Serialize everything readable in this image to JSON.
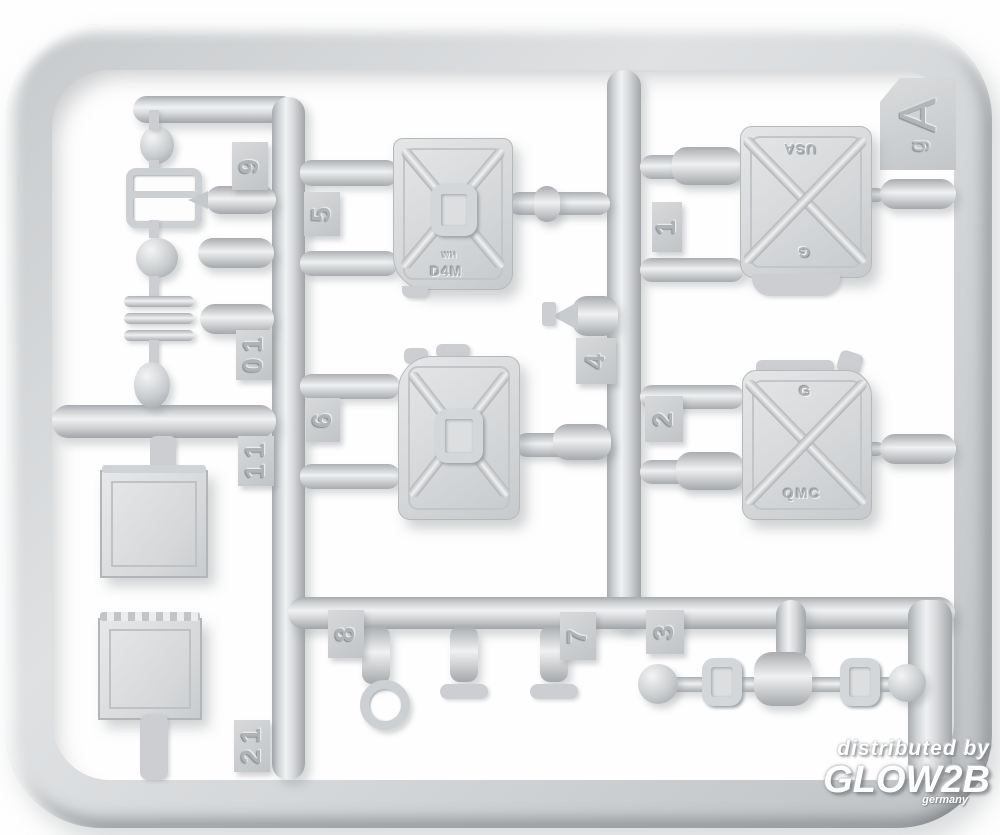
{
  "scene": {
    "subject": "light grey injection-molded plastic model kit sprue photographed on white",
    "background_color": "#ffffff",
    "plastic_color": "#d4d7d9",
    "plastic_highlight": "#f0f1f2",
    "plastic_shadow": "#a2a5a8"
  },
  "sprue_letter": {
    "main": "A",
    "sub": "g"
  },
  "tags": {
    "n1": "1",
    "n2": "2",
    "n3": "3",
    "n4": "4",
    "n5": "5",
    "n6": "6",
    "n7": "7",
    "n8": "8",
    "n9": "9",
    "n10": "10",
    "n11": "11",
    "n12": "12"
  },
  "markings": {
    "german_can_top_small": "WH",
    "german_can_top_main": "D4M",
    "us_can_top_line1": "USA",
    "us_can_top_line2": "G",
    "us_can_bottom_line1": "G",
    "us_can_bottom_line2": "QMC"
  },
  "watermark": {
    "line1": "distributed by",
    "brand": "GLOW2B",
    "country": "germany",
    "color": "#ffffff"
  }
}
